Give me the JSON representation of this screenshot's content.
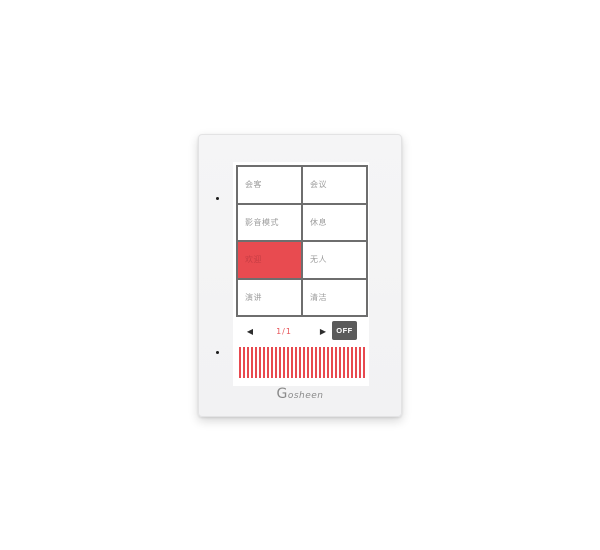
{
  "device": {
    "brand": "Gosheen",
    "scene_buttons": [
      {
        "label": "会客",
        "active": false
      },
      {
        "label": "会议",
        "active": false
      },
      {
        "label": "影音模式",
        "active": false
      },
      {
        "label": "休息",
        "active": false
      },
      {
        "label": "欢迎",
        "active": true
      },
      {
        "label": "无人",
        "active": false
      },
      {
        "label": "演讲",
        "active": false
      },
      {
        "label": "清洁",
        "active": false
      }
    ],
    "pagination": {
      "prev_icon": "◀",
      "page_indicator": "1/1",
      "next_icon": "▶",
      "off_label": "OFF"
    },
    "colors": {
      "active_scene_red": "#e84b50",
      "active_scene_text": "#c73e44",
      "grid_border_gray": "#6e6e6e",
      "scene_text_gray": "#9c9c9c",
      "page_indicator_red": "#e8555a",
      "off_button_bg": "#5a5a5a",
      "off_button_text": "#ffffff",
      "stripe_red": "#e8494f",
      "panel_bg": "#f3f3f4"
    }
  }
}
